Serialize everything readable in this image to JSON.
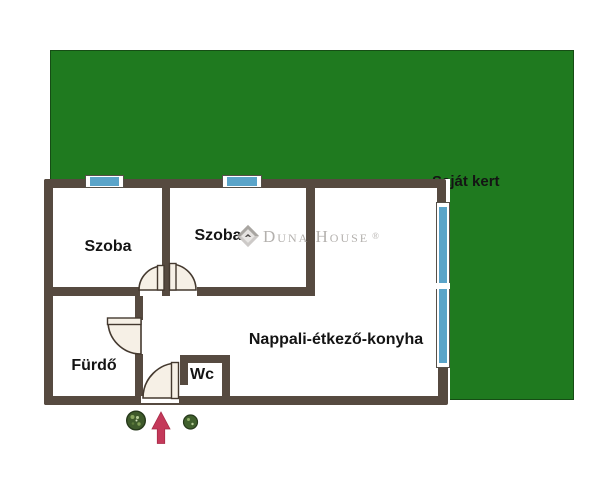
{
  "garden": {
    "label": "Saját kert",
    "color": "#1f7a1f"
  },
  "rooms": {
    "szoba1": {
      "label": "Szoba"
    },
    "szoba2": {
      "label": "Szoba"
    },
    "furdo": {
      "label": "Fürdő"
    },
    "wc": {
      "label": "Wc"
    },
    "nappali": {
      "label": "Nappali-étkező-konyha"
    }
  },
  "watermark": {
    "brand": "Duna House",
    "registered": "®"
  },
  "icons": {
    "entrance_arrow": "entrance-arrow-up-icon",
    "plant_left": "plant-icon",
    "plant_right": "plant-icon",
    "brand_logo": "duna-house-diamond-icon"
  },
  "colors": {
    "garden_green": "#1f7a1f",
    "wall_brown": "#564a40",
    "window_blue": "#5aa4c9",
    "door_cream": "#f6f0e6",
    "arrow_red": "#c4395a",
    "label_text": "#141414",
    "watermark_gray": "#b4b1ae"
  }
}
